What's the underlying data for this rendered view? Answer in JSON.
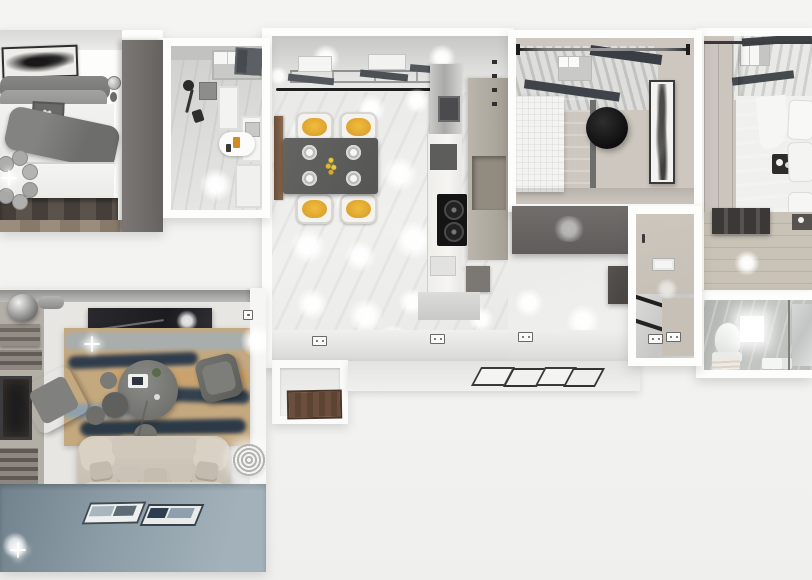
{
  "scene": {
    "type": "3d-apartment-floor-plan-render",
    "view": "top-down cutaway",
    "background_color": "#f3f3f1",
    "wall_color": "#fdfdfb"
  },
  "palette": {
    "accent_chair_cushion": "#e2a92f",
    "wardrobe_grey": "#6e6b69",
    "dining_table_grey": "#5c5c5a",
    "living_floor_blue": "#8b9ca6",
    "rug_tan": "#c4a87e",
    "rug_navy": "#2f3c4c",
    "sofa_beige": "#cbc4b7",
    "wood_floor_dark": "#4a443d",
    "wood_floor_light": "#c6bfb3",
    "tile_grey": "#d8d8d6",
    "cooktop_black": "#141414",
    "doormat_brown": "#6b4f3c"
  },
  "rooms": {
    "bedroom_main": {
      "label": "Main bedroom",
      "furniture": [
        "double bed with grey throw",
        "wall art above headboard",
        "ceiling fan",
        "bedside table with lamp",
        "grey wardrobe",
        "dark pallet bed base on wood floor"
      ]
    },
    "bathroom_small": {
      "label": "Small bathroom",
      "furniture": [
        "skylight window",
        "wall shower set",
        "oval washbasin counter",
        "white cabinets",
        "washer unit"
      ]
    },
    "kitchen_dining": {
      "label": "Open kitchen and dining room",
      "furniture": [
        "dark dining table with 4 yellow-cushion chairs",
        "4 place-setting plates",
        "yellow flower centerpiece",
        "wooden sideboard",
        "fridge column",
        "tall beige cabinets",
        "marble counter run",
        "black 2-burner cooktop"
      ],
      "lighting": "many glowing round ceiling spots",
      "extras": [
        "wall sockets",
        "black curtain rail",
        "window band"
      ]
    },
    "bedroom_guest": {
      "label": "Guest bedroom",
      "furniture": [
        "white bed with grey blanket",
        "round black pendant seat",
        "tall framed artwork",
        "curtain rod with finials",
        "skylight with dark blinds",
        "grey wardrobe band below"
      ]
    },
    "hallway": {
      "label": "Hallway",
      "furniture": [
        "light-switch panel",
        "wall hook",
        "angled mirror panels",
        "dark cabinet",
        "wall sockets"
      ]
    },
    "bedroom_right": {
      "label": "Right bedroom",
      "furniture": [
        "bed with grey duvet and white pillows",
        "breakfast tray on bed",
        "foot-of-bed bench",
        "grey wardrobe",
        "skylight with dark slats",
        "light wood floor"
      ]
    },
    "bathroom_ensuite": {
      "label": "En-suite bathroom",
      "furniture": [
        "toilet",
        "glowing wall light square",
        "folded towels",
        "toiletry bottles",
        "glass shower screen",
        "mirror panel"
      ]
    },
    "living_room": {
      "label": "Living room",
      "furniture": [
        "fireplace with stacked firewood",
        "metallic sphere decor",
        "dark media panel",
        "abstract tan-and-navy rug",
        "round coffee table with tray and plant",
        "two grey armchairs",
        "floor poufs",
        "beige sofa with five pillows",
        "two floor art trays",
        "rope spiral basket",
        "blue-grey floor"
      ],
      "lighting": "sparkle glints on floor"
    },
    "entry": {
      "label": "Entry",
      "furniture": [
        "brown doormat in recessed threshold"
      ]
    },
    "balcony_strip": {
      "label": "Lower terrace strip",
      "furniture": [
        "leaning picture mats",
        "white ledge"
      ]
    }
  }
}
